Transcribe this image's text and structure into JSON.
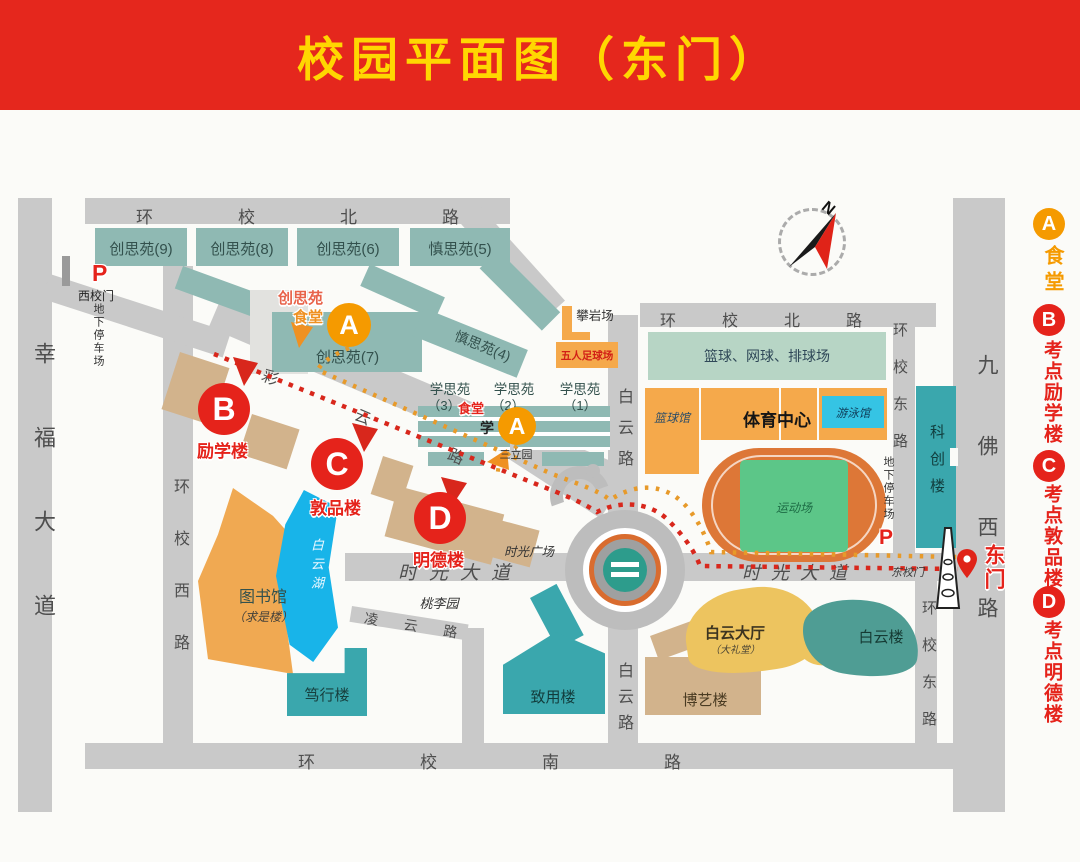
{
  "banner": {
    "title": "校园平面图（东门）"
  },
  "legend": {
    "items": [
      {
        "key": "A",
        "label": "食堂",
        "color": "#f59a00"
      },
      {
        "key": "B",
        "label": "考点励学楼",
        "color": "#e5231b"
      },
      {
        "key": "C",
        "label": "考点敦品楼",
        "color": "#e5231b"
      },
      {
        "key": "D",
        "label": "考点明德楼",
        "color": "#e5231b"
      }
    ]
  },
  "compass": {
    "north": "N"
  },
  "roads": {
    "xingfu_dadao": "幸福大道",
    "huanxiao_beilu": "环校北路",
    "huanxiao_xilu": "环校西路",
    "huanxiao_donglu": "环校东路",
    "huanxiao_nanlu": "环校南路",
    "baiyun_lu": "白云路",
    "jiufo_xilu": "九佛西路",
    "shiguang_dadao": "时光大道",
    "lingyun_lu": "凌云路",
    "caiyun_lu": "彩云路"
  },
  "gates": {
    "west_gate": "西校门",
    "east_gate": "东门",
    "east_gate_road_label": "东校门",
    "parking": "P",
    "underground_parking": "地下停车场"
  },
  "markers": {
    "a": "A",
    "b": "B",
    "c": "C",
    "d": "D"
  },
  "buildings": {
    "chuangsiyuan_9": "创思苑(9)",
    "chuangsiyuan_8": "创思苑(8)",
    "chuangsiyuan_6": "创思苑(6)",
    "chuangsiyuan_7": "创思苑(7)",
    "shensiyuan_5": "慎思苑(5)",
    "shensiyuan_4": "慎思苑(4)",
    "chuangsiyuan_canteen_line1": "创思苑",
    "chuangsiyuan_canteen_line2": "食堂",
    "xuesiyuan": "学思苑",
    "xuesiyuan_3_num": "（3）",
    "xuesiyuan_2_num": "（2）",
    "xuesiyuan_1_num": "（1）",
    "xuesiyuan_canteen": "食堂",
    "xue_char": "学",
    "sanliyuan": "三立园",
    "panyanchang": "攀岩场",
    "wuren_zuqiuchang": "五人足球场",
    "qiuchang": "篮球、网球、排球场",
    "lanqiuguan": "篮球馆",
    "tiyuzhongxin": "体育中心",
    "youyongguan": "游泳馆",
    "yundongchang": "运动场",
    "kechuanglou": "科创楼",
    "tushuguan": "图书馆",
    "qiushilou": "（求是楼）",
    "baiyunhu": "白云湖",
    "duxinglou": "笃行楼",
    "zhiyonglou": "致用楼",
    "boyilou": "博艺楼",
    "baiyundating": "白云大厅",
    "dalitang": "（大礼堂）",
    "baiyunlou": "白云楼",
    "lixuelou": "励学楼",
    "dunpinlou": "敦品楼",
    "mingdelou": "明德楼",
    "shiguang_guangchang": "时光广场",
    "taoliyuan": "桃李园"
  }
}
